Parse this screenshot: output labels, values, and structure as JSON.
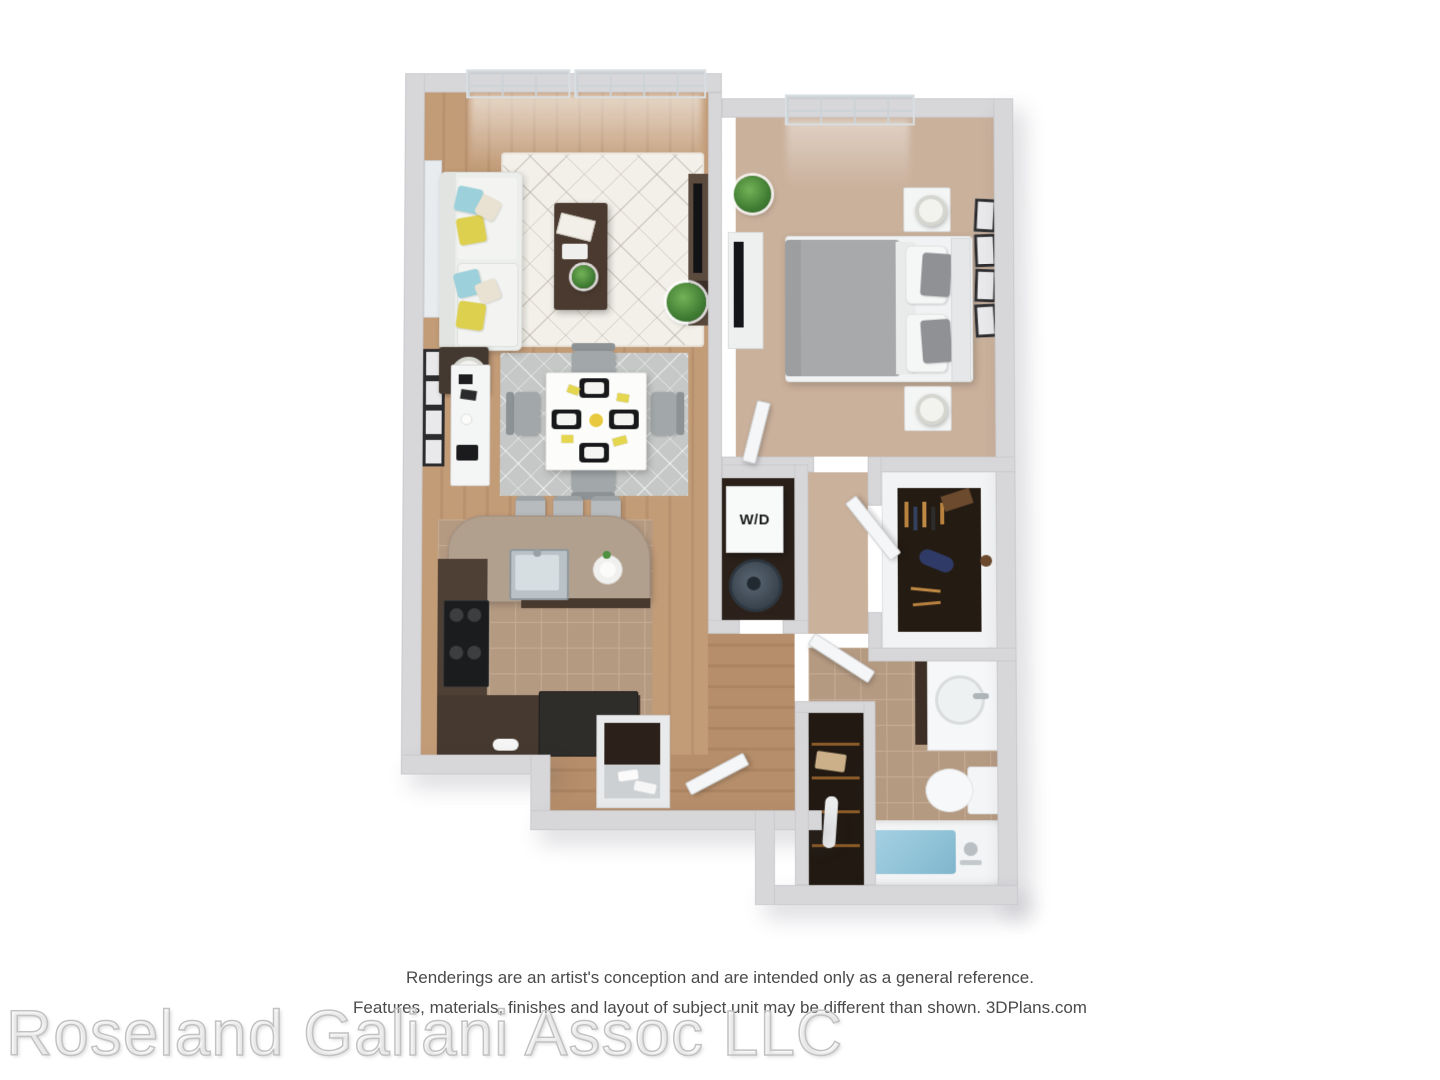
{
  "plan": {
    "wd_label": "W/D"
  },
  "footer": {
    "disclaimer_line1": "Renderings are an artist's conception and are intended only as a general reference.",
    "disclaimer_line2": "Features, materials, finishes and layout of subject unit may be different than shown. 3DPlans.com",
    "watermark": "Roseland Galiani Assoc LLC"
  },
  "colors": {
    "wall": "#d7d7da",
    "wood_floor": "#bd9672",
    "carpet": "#cab19c",
    "tile": "#b59a82",
    "counter": "#b2a08f",
    "cabinet_dark": "#4e4034",
    "closet_interior": "#2b211a",
    "tub_water": "#8fc2d7",
    "pillow_yellow": "#ddd04f",
    "pillow_teal": "#9cd0da",
    "plant_green": "#3f7c33",
    "bed_gray": "#a6a7a9",
    "text_gray": "#4a4a4a"
  }
}
